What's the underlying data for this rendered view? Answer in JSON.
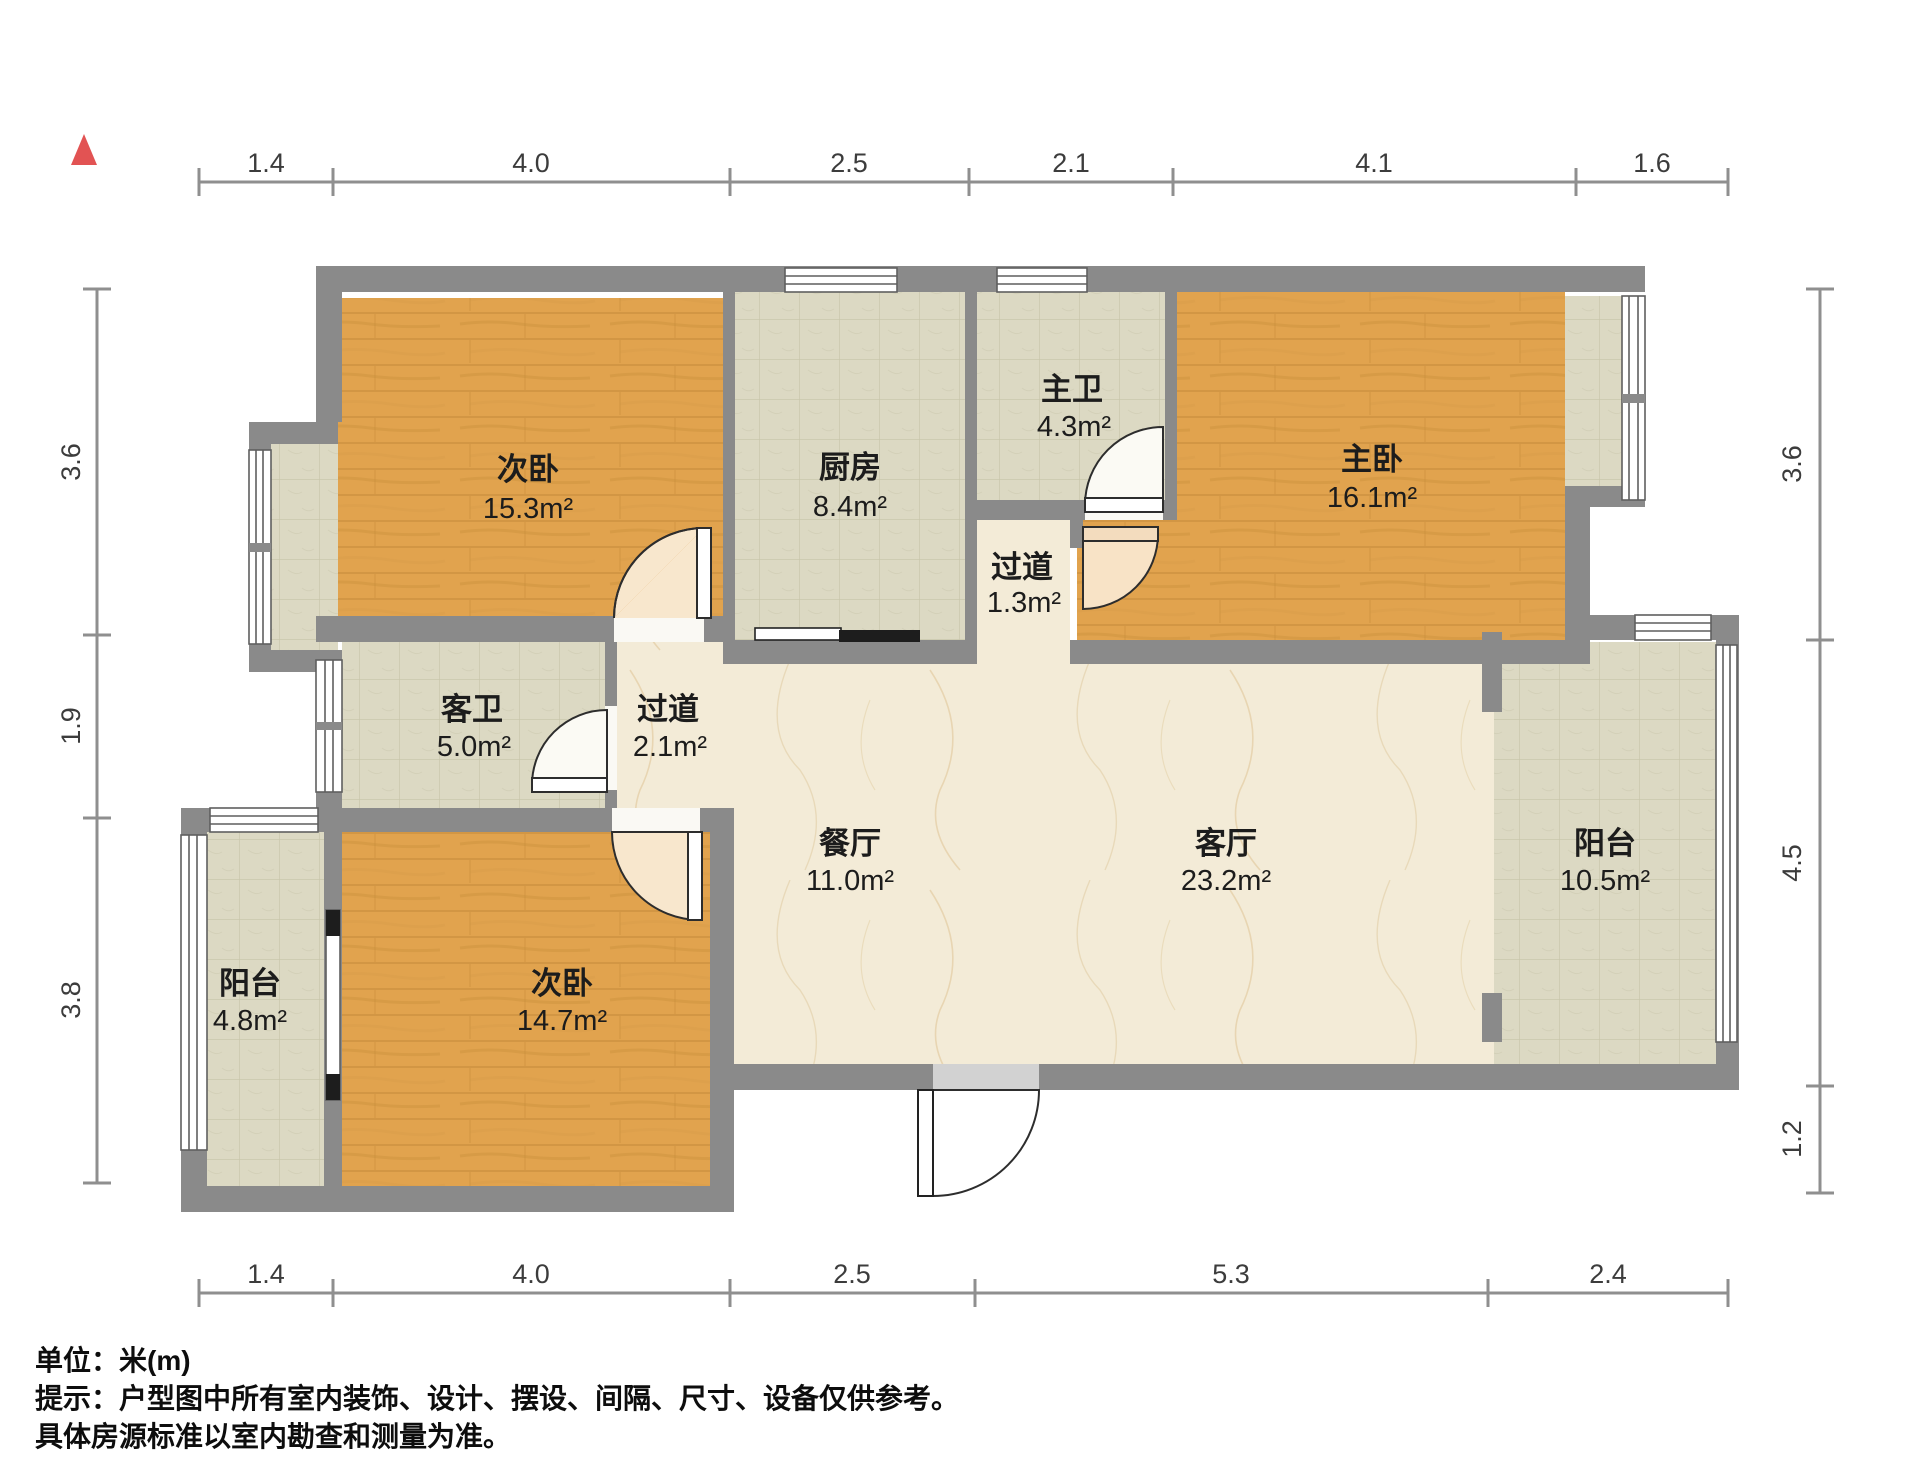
{
  "title": "户型图",
  "north_indicator": {
    "icon": "north-triangle",
    "color": "#e25353"
  },
  "rooms": [
    {
      "id": "ciwo-top",
      "name": "次卧",
      "area": "15.3m²"
    },
    {
      "id": "chufang",
      "name": "厨房",
      "area": "8.4m²"
    },
    {
      "id": "zhuwei",
      "name": "主卫",
      "area": "4.3m²"
    },
    {
      "id": "zhuwo",
      "name": "主卧",
      "area": "16.1m²"
    },
    {
      "id": "guodao-small",
      "name": "过道",
      "area": "1.3m²"
    },
    {
      "id": "kewei",
      "name": "客卫",
      "area": "5.0m²"
    },
    {
      "id": "guodao",
      "name": "过道",
      "area": "2.1m²"
    },
    {
      "id": "canting",
      "name": "餐厅",
      "area": "11.0m²"
    },
    {
      "id": "keting",
      "name": "客厅",
      "area": "23.2m²"
    },
    {
      "id": "yangtai-right",
      "name": "阳台",
      "area": "10.5m²"
    },
    {
      "id": "yangtai-left",
      "name": "阳台",
      "area": "4.8m²"
    },
    {
      "id": "ciwo-bottom",
      "name": "次卧",
      "area": "14.7m²"
    }
  ],
  "dims": {
    "top": [
      "1.4",
      "4.0",
      "2.5",
      "2.1",
      "4.1",
      "1.6"
    ],
    "bottom": [
      "1.4",
      "4.0",
      "2.5",
      "5.3",
      "2.4"
    ],
    "left": [
      "3.6",
      "1.9",
      "3.8"
    ],
    "right": [
      "3.6",
      "4.5",
      "1.2"
    ]
  },
  "footer": {
    "line1": "单位：米(m)",
    "line2": "提示：户型图中所有室内装饰、设计、摆设、间隔、尺寸、设备仅供参考。",
    "line3": "具体房源标准以室内勘查和测量为准。"
  },
  "colors": {
    "wall": "#8a8a8a",
    "wood": "#e1a34e",
    "tile": "#dcd9c3",
    "marble": "#f3ebd7",
    "accent_red": "#e25353"
  }
}
